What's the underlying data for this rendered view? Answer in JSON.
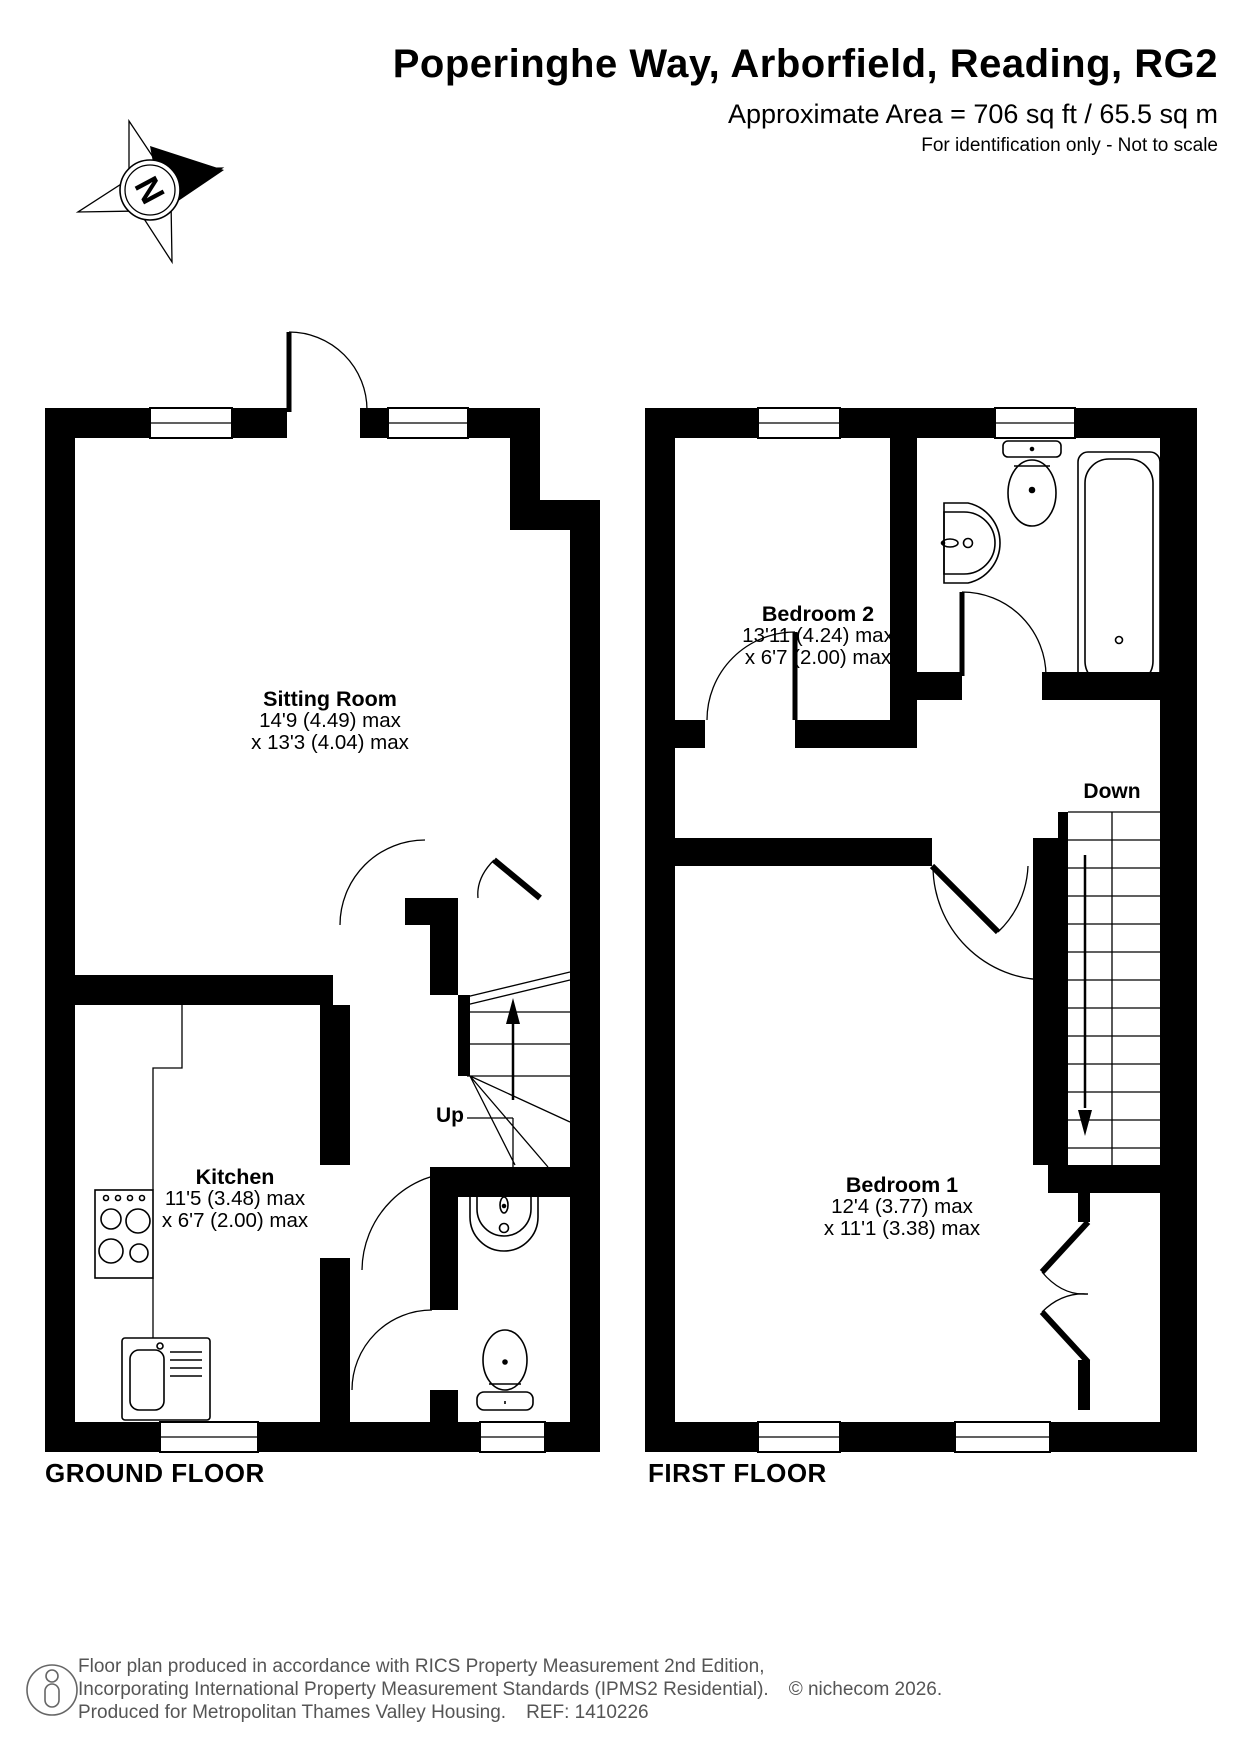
{
  "header": {
    "title": "Poperinghe Way, Arborfield, Reading, RG2",
    "area": "Approximate Area = 706 sq ft / 65.5 sq m",
    "disclaimer": "For identification only - Not to scale"
  },
  "compass": {
    "label": "N"
  },
  "ground_floor": {
    "label": "GROUND FLOOR",
    "stairs_label": "Up",
    "rooms": [
      {
        "name": "Sitting Room",
        "dim_primary": "14'9 (4.49) max",
        "dim_secondary": "x 13'3 (4.04) max"
      },
      {
        "name": "Kitchen",
        "dim_primary": "11'5 (3.48) max",
        "dim_secondary": "x 6'7 (2.00) max"
      }
    ],
    "fixtures": [
      "hob-icon",
      "kitchen-sink-icon",
      "wc-basin-icon",
      "wc-toilet-icon",
      "stairs-up-icon"
    ]
  },
  "first_floor": {
    "label": "FIRST FLOOR",
    "stairs_label": "Down",
    "rooms": [
      {
        "name": "Bedroom 2",
        "dim_primary": "13'11 (4.24) max",
        "dim_secondary": "x 6'7 (2.00) max"
      },
      {
        "name": "Bedroom 1",
        "dim_primary": "12'4 (3.77) max",
        "dim_secondary": "x 11'1 (3.38) max"
      }
    ],
    "fixtures": [
      "toilet-icon",
      "basin-icon",
      "bath-icon",
      "stairs-down-icon",
      "cupboard-doors-icon"
    ]
  },
  "footer": {
    "line1": "Floor plan produced in accordance with RICS Property Measurement 2nd Edition,",
    "line2": "Incorporating International Property Measurement Standards (IPMS2 Residential).",
    "copyright": "© nichecom 2026.",
    "line3": "Produced for Metropolitan Thames Valley Housing.",
    "ref": "REF:  1410226"
  },
  "colors": {
    "wall": "#000000",
    "text": "#000000",
    "footer_text": "#555555"
  }
}
